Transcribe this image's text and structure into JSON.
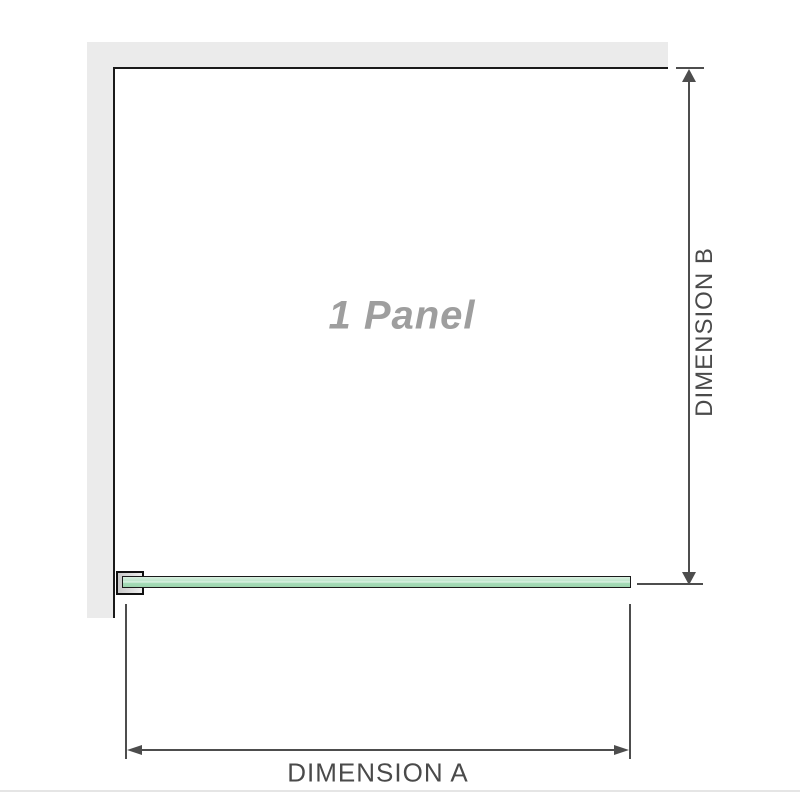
{
  "diagram": {
    "panel_label": "1 Panel",
    "dimensions": {
      "a_label": "DIMENSION A",
      "b_label": "DIMENSION B"
    },
    "colors": {
      "wall_fill": "#ebebeb",
      "panel_outline": "#1a1a1a",
      "dimension_line": "#4d4d4d",
      "label_text": "#4a4a4a",
      "panel_label_text": "#9e9e9e",
      "glass_fill": "#a6dcb8",
      "glass_highlight": "#d8efe0",
      "clamp_fill": "#ededed"
    }
  }
}
